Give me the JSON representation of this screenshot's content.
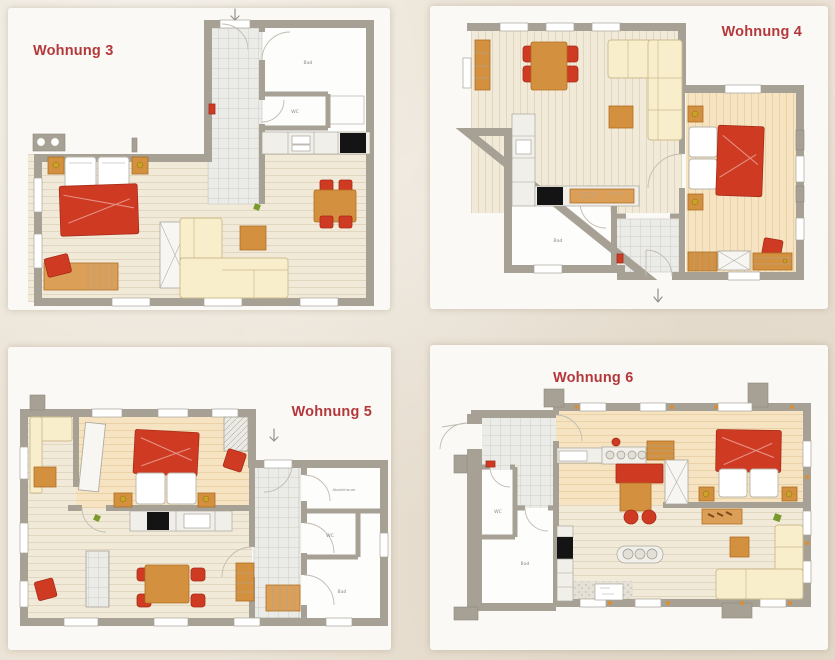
{
  "page": {
    "description": "Four apartment floor plans on beige paper background"
  },
  "palette": {
    "page_bg": "#ebe3d6",
    "card_bg": "#faf9f6",
    "title_red": "#b4383b",
    "wall": "#a7a195",
    "wall_dark": "#8e887c",
    "wood_pale": "#f2ead8",
    "wood_pale_ln": "#ddd2ba",
    "wood_warm": "#f5e3c2",
    "wood_warm_ln": "#e7cd9f",
    "tile_bg": "#ebebe7",
    "tile_line": "#c8c8c2",
    "furn_red": "#cf3a23",
    "furn_red_dark": "#a62c18",
    "furn_orange": "#d3913f",
    "furn_orange_dark": "#b06f23",
    "cream": "#f8eecb",
    "cream_dark": "#cdbb8d",
    "appliance_black": "#141414",
    "counter": "#f1efe9",
    "counter_line": "#a9a49a",
    "label_gray": "#8b8b88",
    "lamp_gold": "#c9a227",
    "plant_green": "#7a9a2e"
  },
  "plans": {
    "w3": {
      "title": "Wohnung 3",
      "rooms": {
        "bad": "Bad",
        "wc": "WC"
      }
    },
    "w4": {
      "title": "Wohnung 4",
      "rooms": {
        "bad": "Bad"
      }
    },
    "w5": {
      "title": "Wohnung 5",
      "rooms": {
        "abstellraum": "Abstellraum",
        "wc": "WC",
        "bad": "Bad"
      }
    },
    "w6": {
      "title": "Wohnung 6",
      "rooms": {
        "wc": "WC",
        "bad": "Bad"
      }
    }
  }
}
